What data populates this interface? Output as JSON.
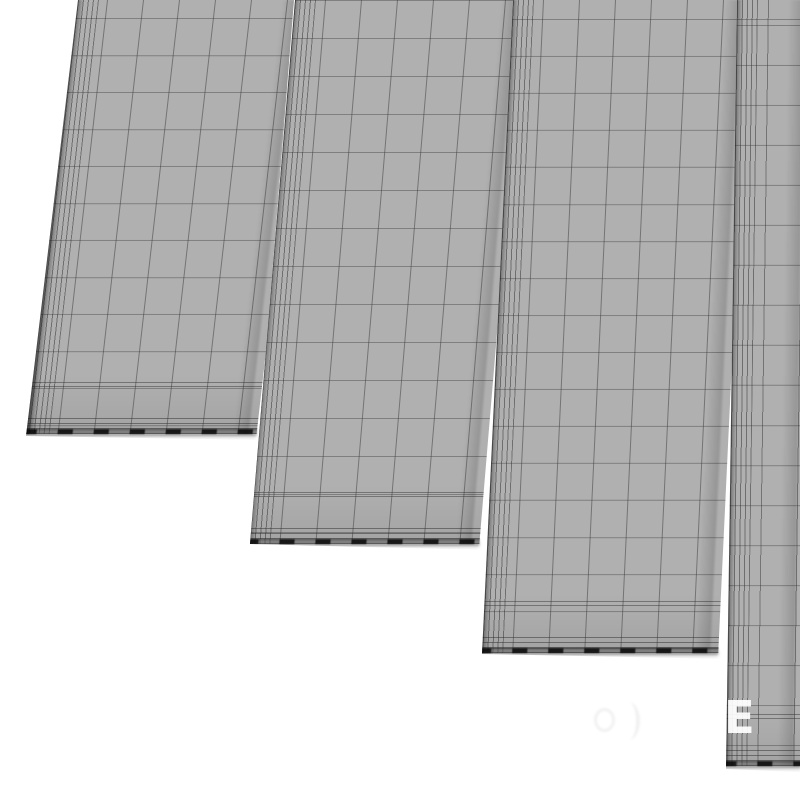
{
  "scene": {
    "description": "Wireframe clay render of four staggered flat planks on white background",
    "background_color": "#ffffff",
    "panel_fill_color": "#b0b0b0",
    "grid_line_color": "#8c8c8c",
    "seam_color": "#2e2e2e",
    "bottom_edge_color": "#141414",
    "panel_count": 4
  },
  "watermark": {
    "letter": "E",
    "letter_color": "#ffffff"
  },
  "panels": [
    {
      "label": "plank-1",
      "box": {
        "left": 26,
        "top": 0,
        "width": 268,
        "height": 440
      },
      "clip": "polygon(52px 0px, 268px 0px, 233px 440px, 0px 436px)",
      "skew_deg": -6.5,
      "surface_left": -80,
      "edge_x": 132,
      "grid_size_x": 36,
      "grid_size_y": 37,
      "grid_offset_x": 17,
      "grid_offset_y": 18
    },
    {
      "label": "plank-2",
      "box": {
        "left": 250,
        "top": 0,
        "width": 263,
        "height": 550
      },
      "clip": "polygon(45px 0px, 263px 0px, 239px 550px, 0px 544px)",
      "skew_deg": -4.8,
      "surface_left": -60,
      "edge_x": 105,
      "grid_size_x": 36,
      "grid_size_y": 38,
      "grid_offset_x": 27,
      "grid_offset_y": 0
    },
    {
      "label": "plank-3",
      "box": {
        "left": 482,
        "top": 0,
        "width": 255,
        "height": 659
      },
      "clip": "polygon(31px 0px, 255px 0px, 247px 659px, 0px 654px)",
      "skew_deg": -2.7,
      "surface_left": -40,
      "edge_x": 71,
      "grid_size_x": 36,
      "grid_size_y": 37,
      "grid_offset_x": 29,
      "grid_offset_y": 19
    },
    {
      "label": "plank-4",
      "box": {
        "left": 726,
        "top": 0,
        "width": 74,
        "height": 772
      },
      "clip": "polygon(11px 0px, 74px 0px, 74px 772px, 0px 769px)",
      "skew_deg": -0.8,
      "surface_left": -30,
      "edge_x": 41,
      "grid_size_x": 36,
      "grid_size_y": 40,
      "grid_offset_x": 0,
      "grid_offset_y": 25
    }
  ]
}
